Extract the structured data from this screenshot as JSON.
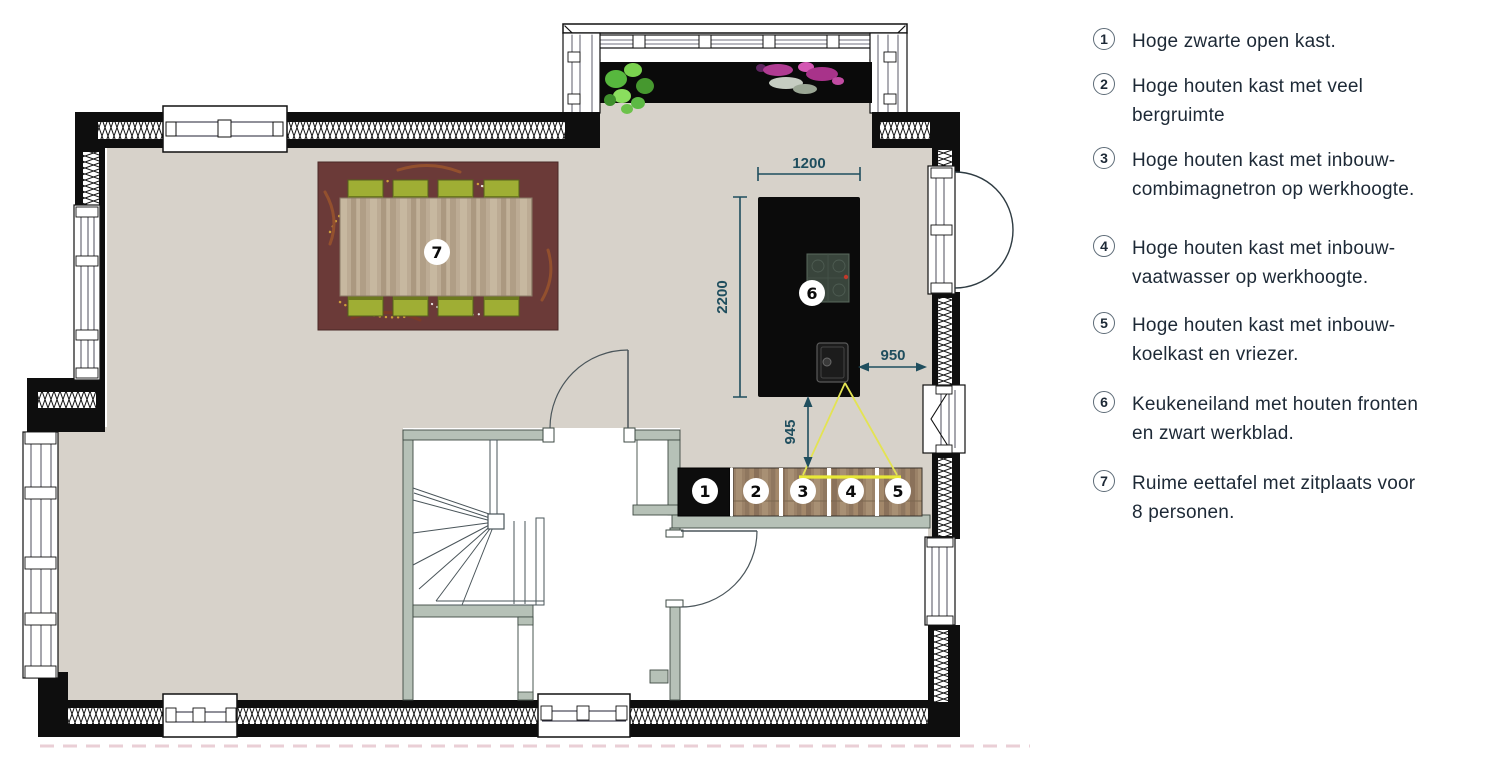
{
  "plan": {
    "badges": [
      "1",
      "2",
      "3",
      "4",
      "5",
      "6",
      "7"
    ],
    "dimensions": {
      "island_width": "1200",
      "island_depth": "2200",
      "gap_island_to_wall": "950",
      "gap_island_to_cabinets": "945"
    },
    "colors": {
      "wall": "#0e0e0e",
      "floor": "#d7d2ca",
      "interior_wall": "#b6c1b7",
      "dimension": "#1f4e5e",
      "light_cone": "#e8e838",
      "island": "#0b0b0b",
      "cabinet_wood": "#9b8268",
      "chair": "#9fae34",
      "rug": "#6b3a38"
    }
  },
  "legend": {
    "items": [
      {
        "num": "1",
        "line1": "Hoge zwarte open kast.",
        "line2": ""
      },
      {
        "num": "2",
        "line1": "Hoge houten kast met veel",
        "line2": "bergruimte"
      },
      {
        "num": "3",
        "line1": "Hoge houten kast met inbouw-",
        "line2": "combimagnetron op werkhoogte."
      },
      {
        "num": "4",
        "line1": "Hoge houten kast met inbouw-",
        "line2": "vaatwasser op werkhoogte."
      },
      {
        "num": "5",
        "line1": "Hoge houten kast met inbouw-",
        "line2": "koelkast en vriezer."
      },
      {
        "num": "6",
        "line1": "Keukeneiland met houten fronten",
        "line2": "en zwart werkblad."
      },
      {
        "num": "7",
        "line1": "Ruime eettafel met zitplaats voor",
        "line2": "8 personen."
      }
    ]
  }
}
